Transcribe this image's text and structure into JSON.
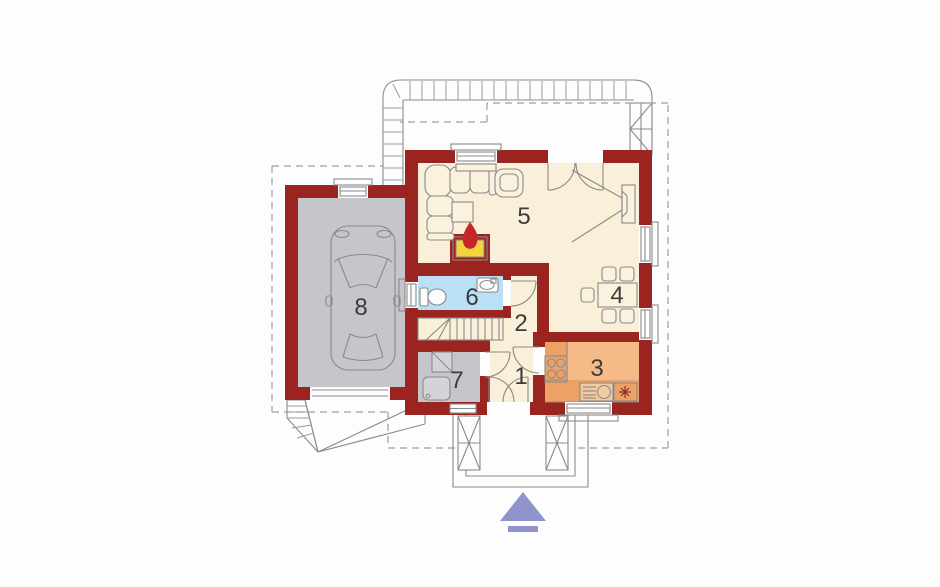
{
  "scene": {
    "background": "#fdfdfd"
  },
  "colors": {
    "wall": "#9a2420",
    "floor_main": "#faefd8",
    "floor_utility": "#c6c5ca",
    "floor_bathroom": "#b9e0f4",
    "floor_kitchen": "#f5ba88",
    "kitchen_counter": "#eca267",
    "firebox": "#f2d43c",
    "flame": "#c5262b",
    "entrance_arrow": "#9193cb"
  },
  "rooms": [
    {
      "label": "1"
    },
    {
      "label": "2"
    },
    {
      "label": "3"
    },
    {
      "label": "4"
    },
    {
      "label": "5"
    },
    {
      "label": "6"
    },
    {
      "label": "7"
    },
    {
      "label": "8"
    }
  ]
}
